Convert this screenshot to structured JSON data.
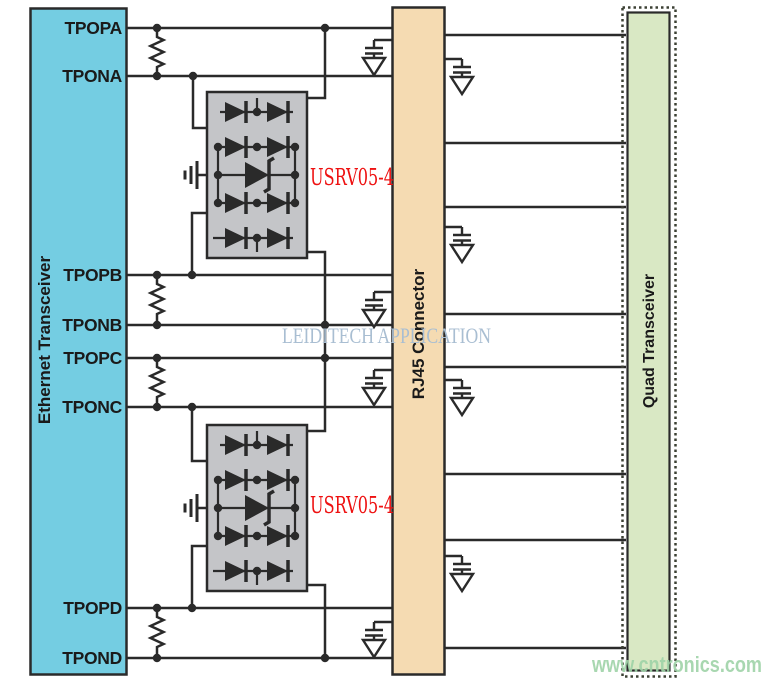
{
  "blocks": {
    "ethernet_transceiver": "Ethernet Transceiver",
    "rj45_connector": "RJ45 Connector",
    "quad_transceiver": "Quad Transceiver"
  },
  "pins": [
    "TPOPA",
    "TPONA",
    "TPOPB",
    "TPONB",
    "TPOPC",
    "TPONC",
    "TPOPD",
    "TPOND"
  ],
  "tvs": {
    "part_number": "USRV05-4",
    "instance_count": 2
  },
  "watermarks": {
    "center": "LEIDITECH APPLICATION",
    "bottom_right": "www.cntronics.com"
  },
  "colors": {
    "wire": "#2a2a2a",
    "block_cyan": "#74cde2",
    "block_tan": "#f5dbb2",
    "block_green": "#d9e8c4",
    "green_dotted_border": "#3c4034",
    "tvs_gray": "#c4c5c8",
    "label_red": "#ee1111",
    "watermark_blue": "#a9bed2",
    "watermark_green": "#9fd3a8"
  }
}
